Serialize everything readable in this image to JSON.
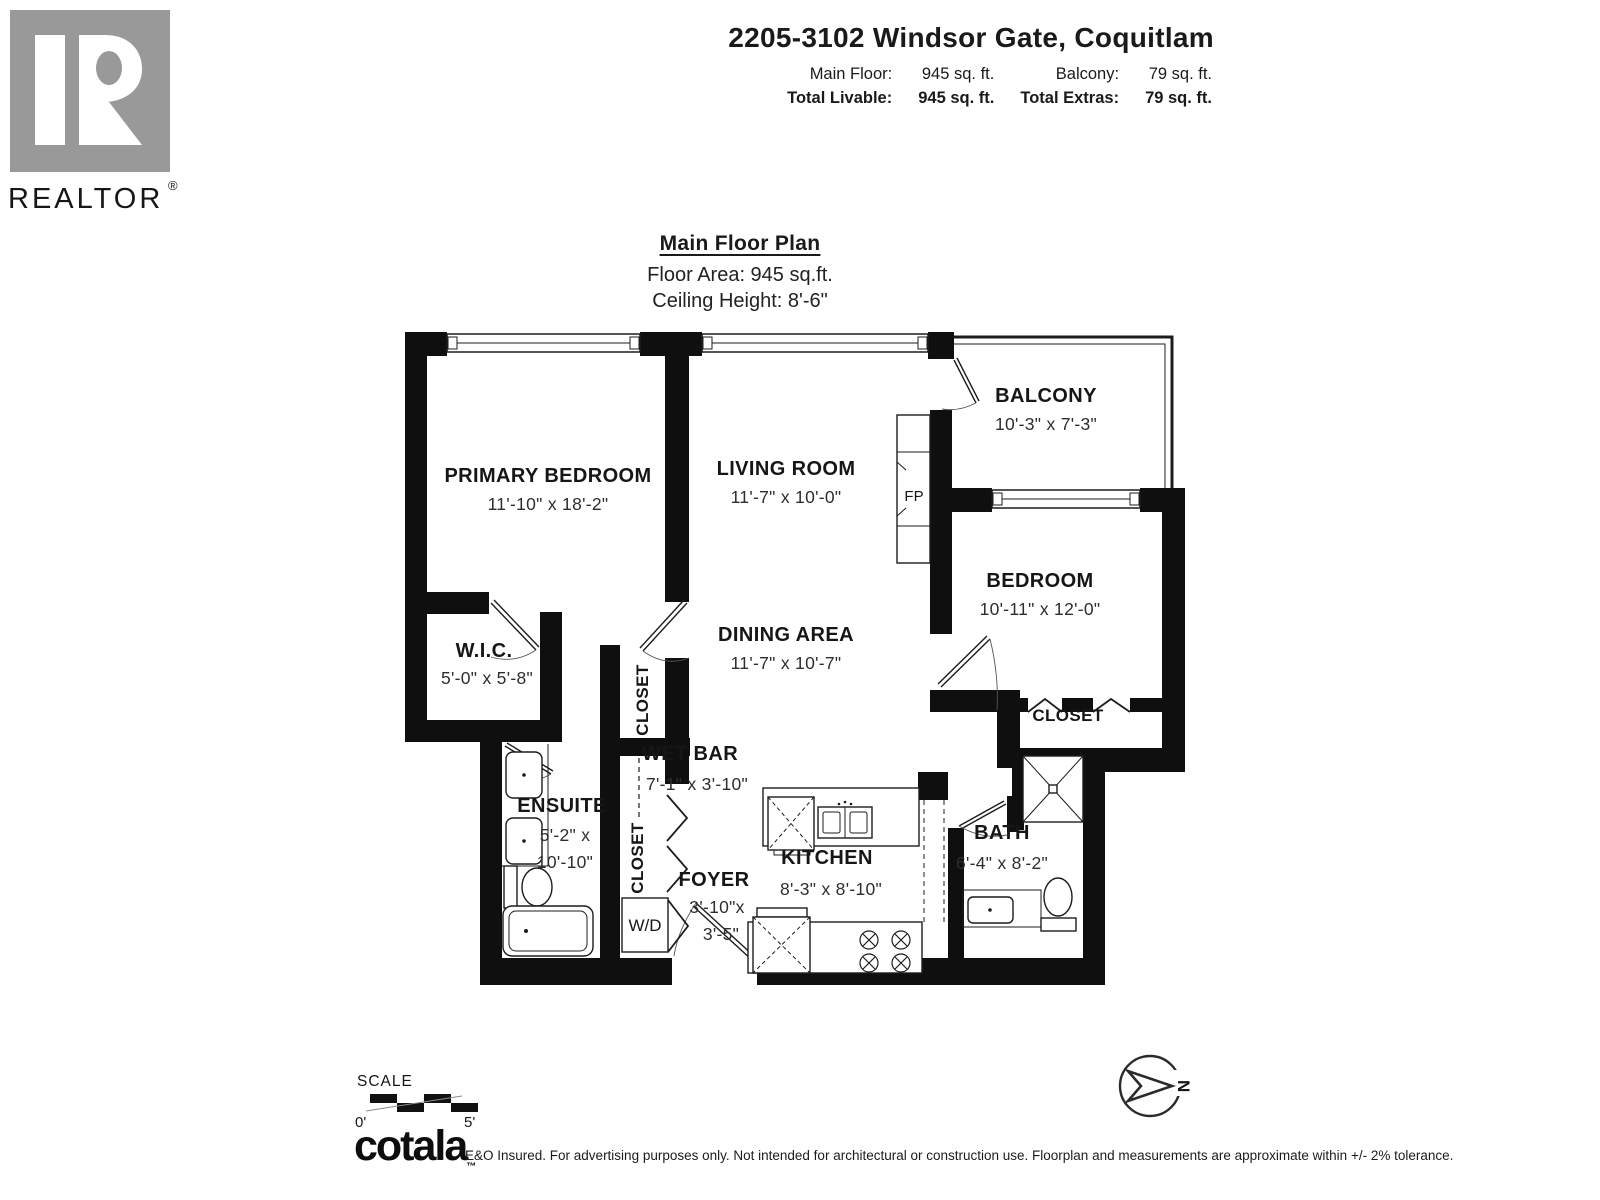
{
  "branding": {
    "realtor_logo_text": "REALTOR",
    "registered_mark": "®"
  },
  "header": {
    "title": "2205-3102 Windsor Gate, Coquitlam",
    "stats": [
      {
        "label": "Main Floor:",
        "value": "945 sq. ft."
      },
      {
        "label": "Balcony:",
        "value": "79 sq. ft."
      },
      {
        "label": "Total Livable:",
        "value": "945 sq. ft."
      },
      {
        "label": "Total Extras:",
        "value": "79 sq. ft."
      }
    ]
  },
  "plan_header": {
    "title": "Main Floor Plan",
    "floor_area": "Floor Area: 945 sq.ft.",
    "ceiling_height": "Ceiling Height: 8'-6\""
  },
  "rooms": {
    "primary_bedroom": {
      "name": "PRIMARY BEDROOM",
      "dims": "11'-10\" x 18'-2\""
    },
    "living_room": {
      "name": "LIVING ROOM",
      "dims": "11'-7\" x 10'-0\""
    },
    "balcony": {
      "name": "BALCONY",
      "dims": "10'-3\" x 7'-3\""
    },
    "bedroom": {
      "name": "BEDROOM",
      "dims": "10'-11\" x 12'-0\""
    },
    "wic": {
      "name": "W.I.C.",
      "dims": "5'-0\" x 5'-8\""
    },
    "dining": {
      "name": "DINING AREA",
      "dims": "11'-7\" x 10'-7\""
    },
    "closet_dining": {
      "name": "CLOSET"
    },
    "wet_bar": {
      "name": "WET BAR",
      "dims": "7'-1\" x 3'-10\""
    },
    "ensuite": {
      "name": "ENSUITE",
      "dims1": "5'-2\" x",
      "dims2": "10'-10\""
    },
    "closet_hall": {
      "name": "CLOSET"
    },
    "foyer": {
      "name": "FOYER",
      "dims1": "3'-10\"x",
      "dims2": "3'-5\""
    },
    "kitchen": {
      "name": "KITCHEN",
      "dims": "8'-3\" x 8'-10\""
    },
    "bath": {
      "name": "BATH",
      "dims": "6'-4\" x 8'-2\""
    },
    "closet_bedroom": {
      "name": "CLOSET"
    }
  },
  "fixture_labels": {
    "washer_dryer": "W/D",
    "fireplace": "FP"
  },
  "scale_bar": {
    "label": "SCALE",
    "start": "0'",
    "end": "5'"
  },
  "compass": {
    "north": "N"
  },
  "footer": {
    "logo": "cotala",
    "trademark": "™",
    "disclaimer": "E&O Insured. For advertising purposes only. Not intended for architectural or construction use. Floorplan and measurements are approximate within +/- 2% tolerance."
  }
}
